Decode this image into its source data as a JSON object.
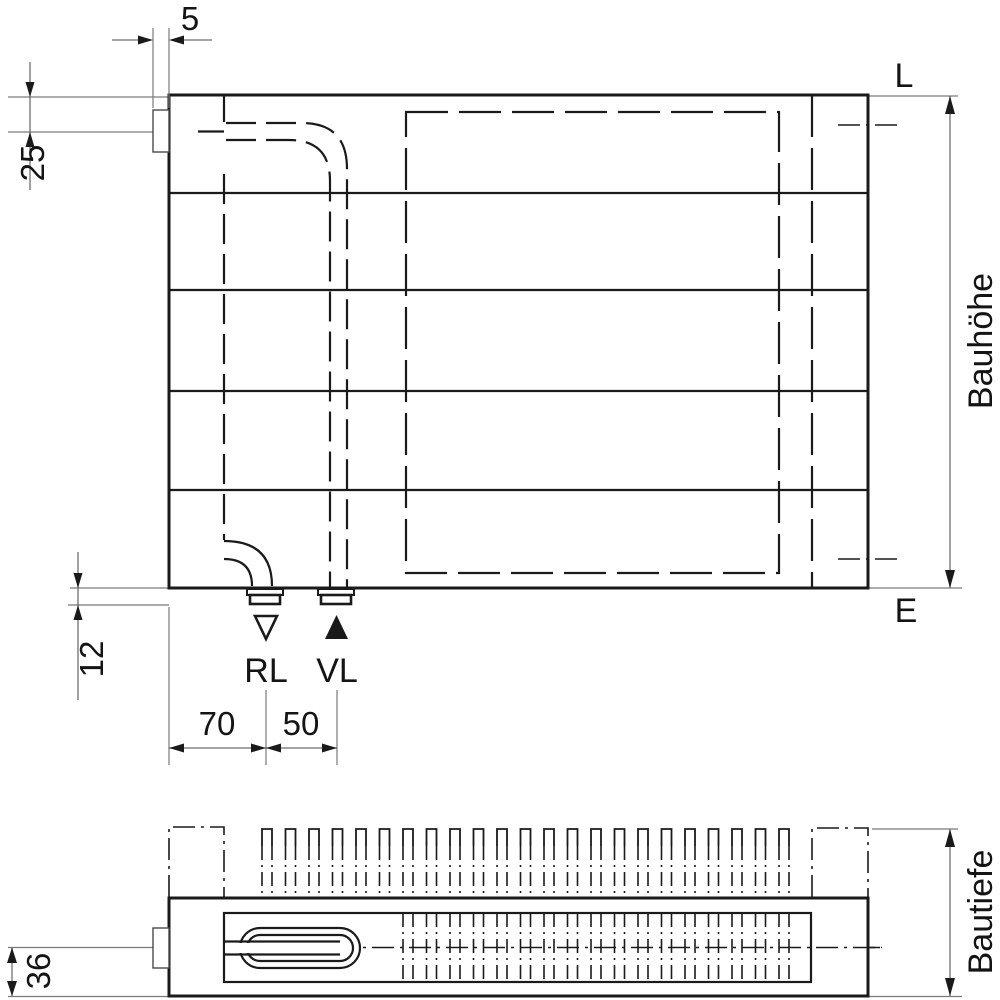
{
  "front_view": {
    "dimensions": {
      "bracket_gap": "5",
      "inlet_offset_from_top": "25",
      "nipple_protrusion": "12",
      "edge_to_rl": "70",
      "rl_to_vl": "50"
    },
    "labels": {
      "top_edge": "L",
      "bottom_edge": "E",
      "return_connection": "RL",
      "supply_connection": "VL",
      "height": "Bauhöhe"
    },
    "panel_sections": 5,
    "connections": [
      "RL",
      "VL"
    ]
  },
  "top_view": {
    "dimensions": {
      "centerline_to_front": "36"
    },
    "labels": {
      "depth": "Bautiefe"
    },
    "fins": {
      "count": 23
    }
  },
  "colors": {
    "line": "#1a1a1a",
    "dim_line": "#7a7a7a",
    "background": "#ffffff"
  }
}
